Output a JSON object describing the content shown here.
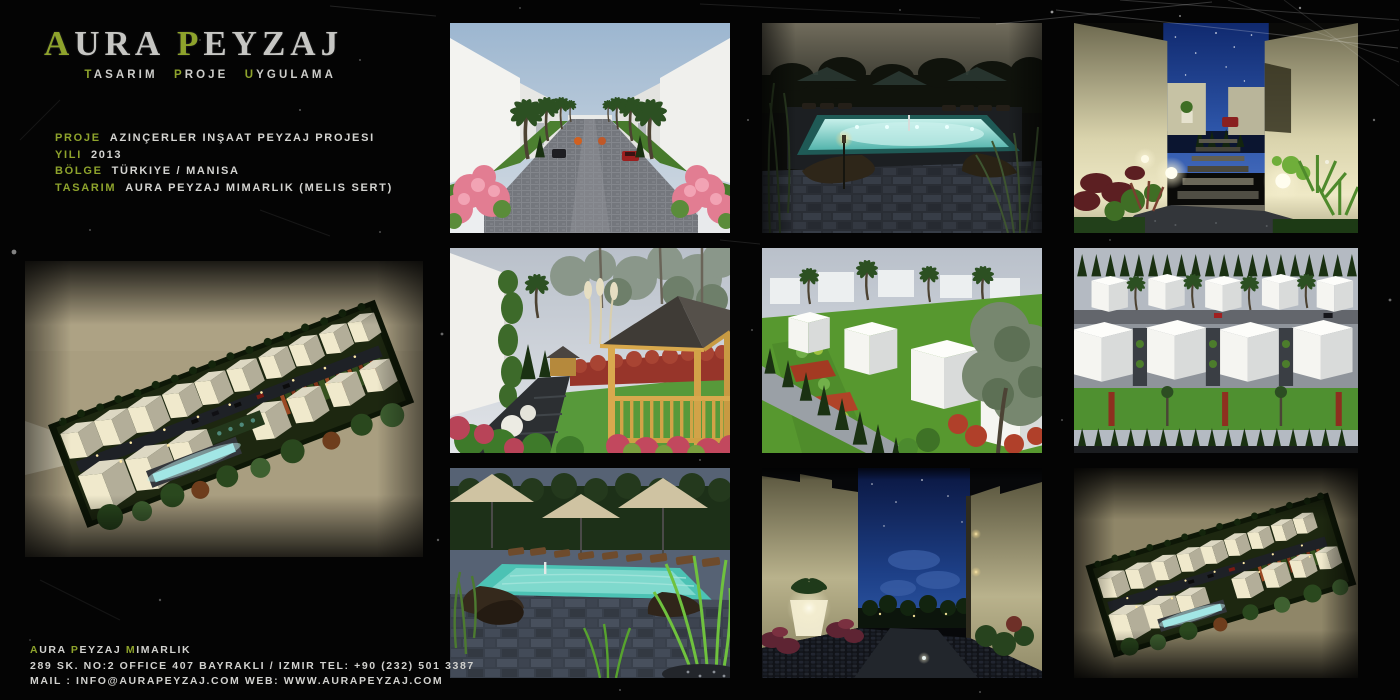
{
  "page": {
    "background_color": "#040404",
    "accent_color": "#8ea32c",
    "text_color": "#d4d4d1"
  },
  "logo": {
    "word1_initial": "A",
    "word1_rest": "URA",
    "word2_initial": "P",
    "word2_rest": "EYZAJ",
    "tagline": {
      "w1i": "T",
      "w1r": "ASARIM",
      "w2i": "P",
      "w2r": "ROJE",
      "w3i": "U",
      "w3r": "YGULAMA"
    }
  },
  "project": {
    "rows": [
      {
        "label": "PROJE",
        "value": "AZINÇERLER INŞAAT PEYZAJ PROJESI"
      },
      {
        "label": "YILI",
        "value": "2013"
      },
      {
        "label": "BÖLGE",
        "value": "TÜRKIYE / MANISA"
      },
      {
        "label": "TASARIM",
        "value": "AURA PEYZAJ MIMARLIK (MELIS SERT)"
      }
    ]
  },
  "footer": {
    "company": {
      "w1i": "A",
      "w1r": "URA",
      "w2i": "P",
      "w2r": "EYZAJ",
      "w3i": "M",
      "w3r": "IMARLIK"
    },
    "address": "289 SK. NO:2 OFFICE 407 BAYRAKLI / IZMIR TEL: +90 (232) 501 3387",
    "contact": "MAIL : INFO@AURAPEYZAJ.COM WEB: WWW.AURAPEYZAJ.COM"
  }
}
